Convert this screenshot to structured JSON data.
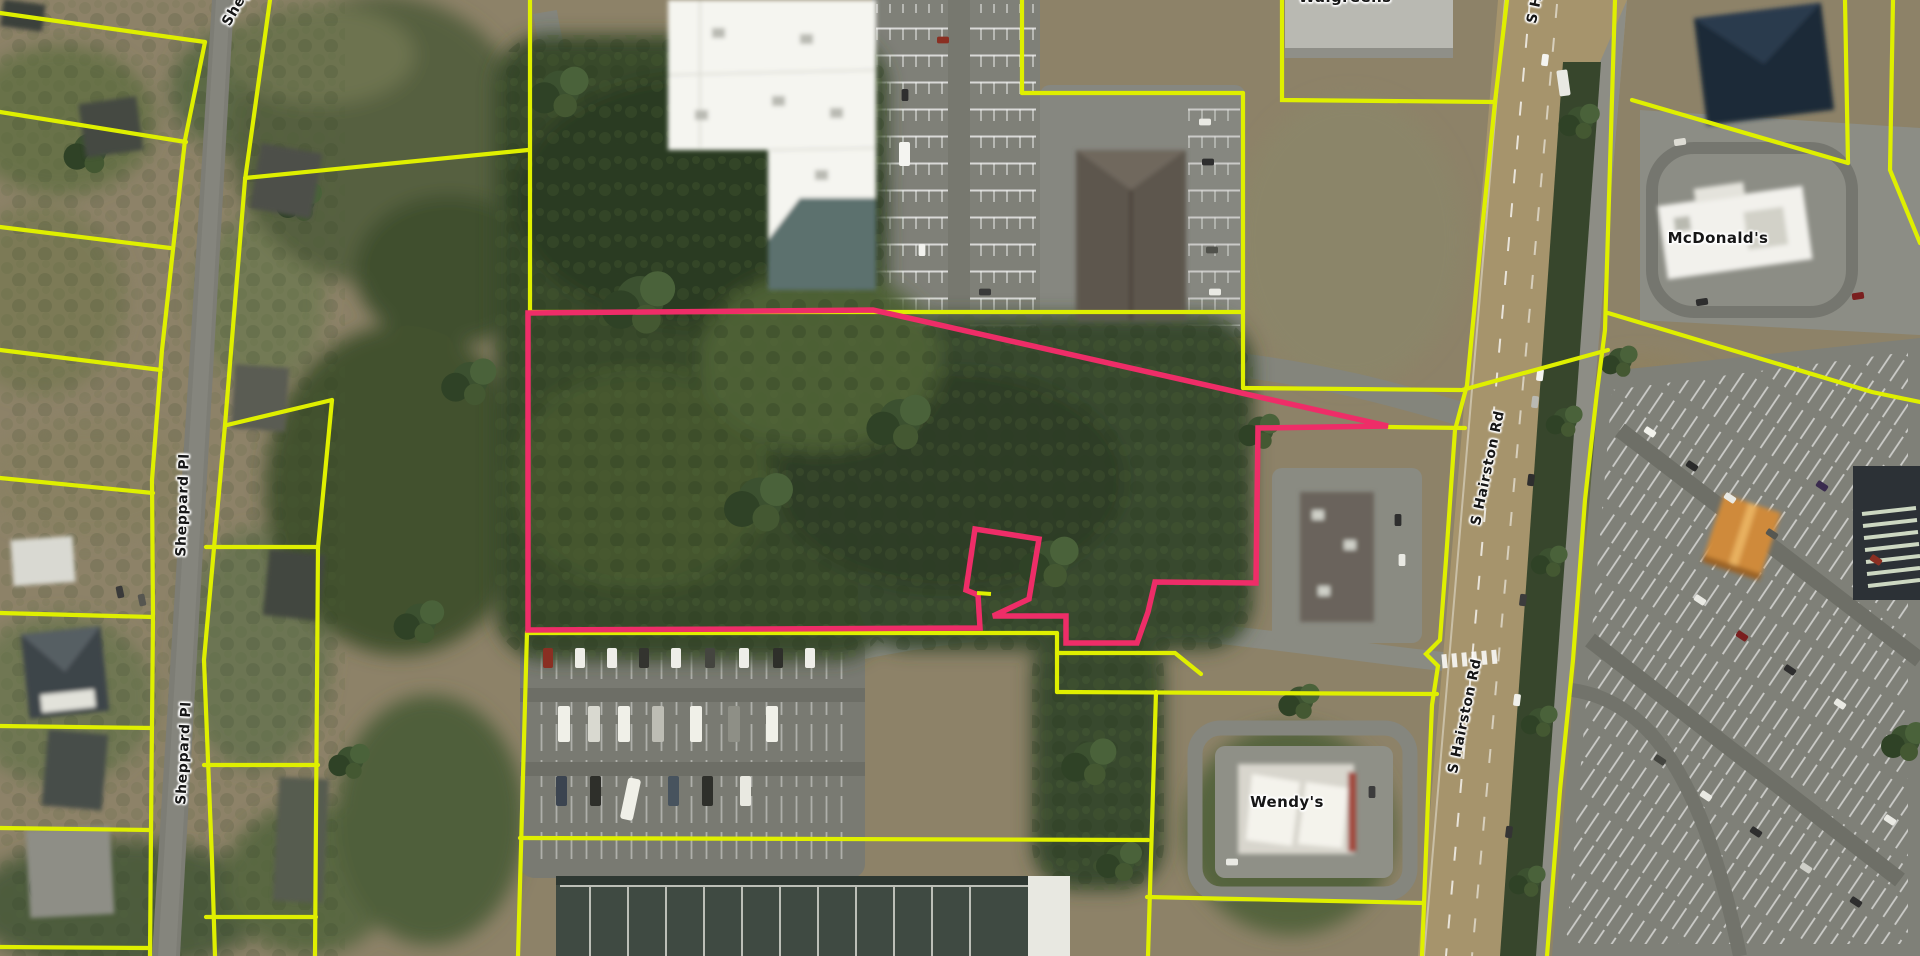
{
  "map": {
    "street_labels": {
      "sheppard_top": "Sheppard Pl",
      "sheppard_mid": "Sheppard Pl",
      "sheppard_bottom": "Sheppard Pl",
      "hairston_top": "S Hairston Rd",
      "hairston_mid": "S Hairston Rd",
      "hairston_bottom": "S Hairston Rd"
    },
    "poi_labels": {
      "walgreens": "Walgreens",
      "mcdonalds": "McDonald's",
      "wendys": "Wendy's"
    },
    "overlay": {
      "parcel_line_color": "#dfef00",
      "selected_parcel_color": "#ee2d68"
    }
  }
}
